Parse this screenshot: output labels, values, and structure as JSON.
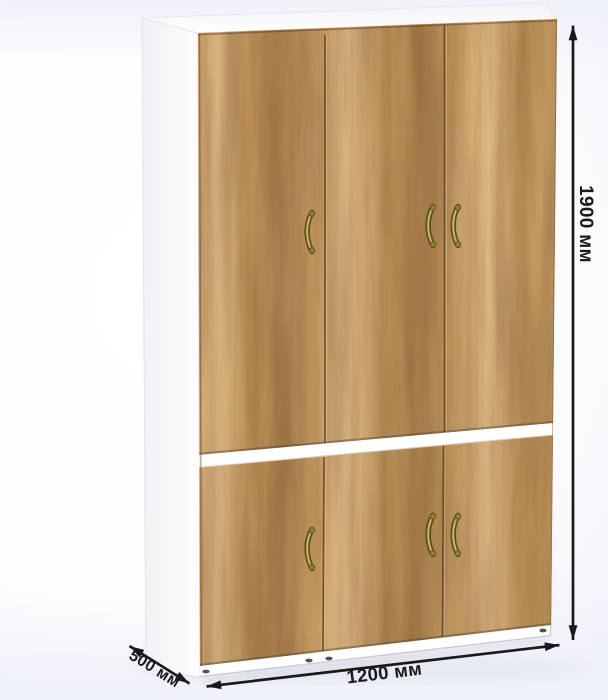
{
  "dimension_labels": {
    "height": "1900 мм",
    "width": "1200 мм",
    "depth": "500 мм"
  },
  "wardrobe": {
    "top_section_door_count": 3,
    "bottom_section_door_count": 3,
    "handle_count": 6,
    "handle_style": "antique brass bow handle",
    "front_finish": "golden oak woodgrain",
    "carcass_finish": "white"
  },
  "colors": {
    "wood_light": "#e3bf8a",
    "wood_mid": "#c99e66",
    "wood_mid2": "#bd9058",
    "wood_dark": "#aa7f4c",
    "grain_streak": "#6b4a26",
    "door_gap_line": "#5e4628",
    "handle_dark": "#5a4f1e",
    "handle_mid": "#8d7f33",
    "handle_light": "#c8b766",
    "carcass_white": "#ffffff",
    "dimension_color": "#1a1a1a",
    "background_tint": "#eef0f8",
    "shadow_tint": "#d6dae6"
  }
}
